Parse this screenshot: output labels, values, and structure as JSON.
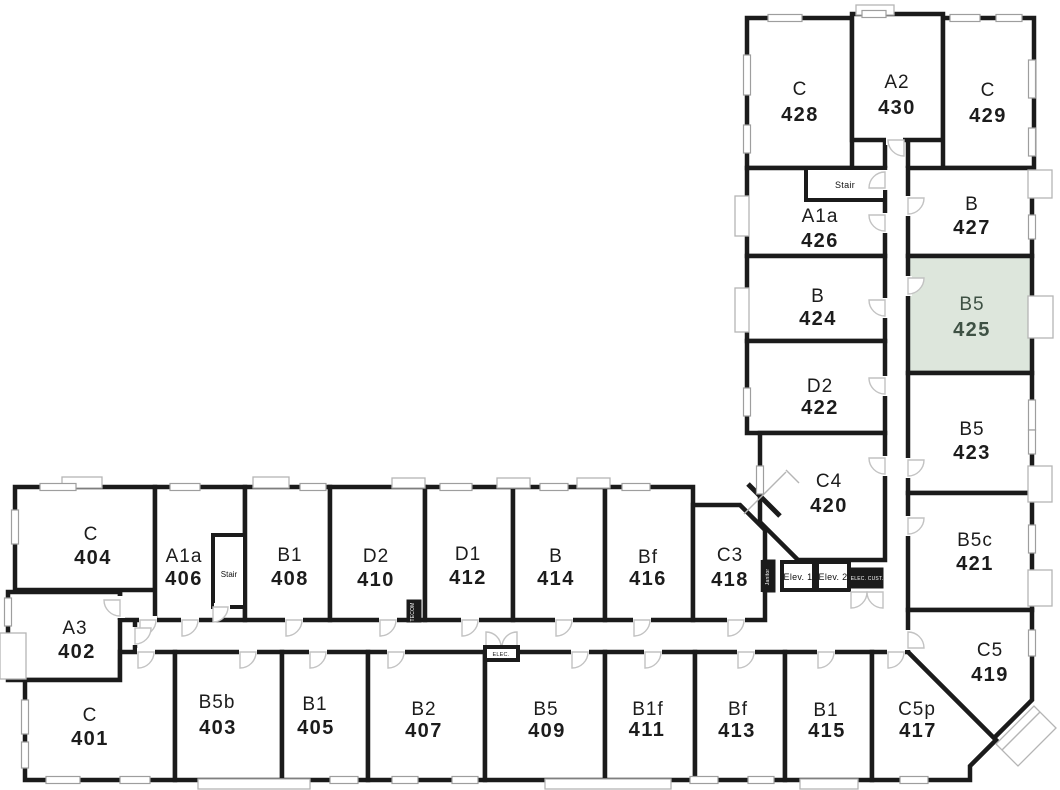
{
  "plan": {
    "description": "Residential building floor plan, fourth floor, L-shaped wing layout",
    "highlight": {
      "unit_type": "B5",
      "unit_number": "425",
      "fill": "#dde6dc",
      "text_color": "#3e5144"
    },
    "colors": {
      "wall": "#1b1b1b",
      "background": "#ffffff",
      "door_arc": "#c2c2c2",
      "window": "#9e9e9e",
      "label": "#1c1c1c"
    }
  },
  "units": [
    {
      "type": "C",
      "number": "428"
    },
    {
      "type": "A2",
      "number": "430"
    },
    {
      "type": "C",
      "number": "429"
    },
    {
      "type": "A1a",
      "number": "426"
    },
    {
      "type": "B",
      "number": "427"
    },
    {
      "type": "B",
      "number": "424"
    },
    {
      "type": "B5",
      "number": "425",
      "highlighted": true
    },
    {
      "type": "D2",
      "number": "422"
    },
    {
      "type": "B5",
      "number": "423"
    },
    {
      "type": "C4",
      "number": "420"
    },
    {
      "type": "B5c",
      "number": "421"
    },
    {
      "type": "C5",
      "number": "419"
    },
    {
      "type": "C",
      "number": "404"
    },
    {
      "type": "A1a",
      "number": "406"
    },
    {
      "type": "B1",
      "number": "408"
    },
    {
      "type": "D2",
      "number": "410"
    },
    {
      "type": "D1",
      "number": "412"
    },
    {
      "type": "B",
      "number": "414"
    },
    {
      "type": "Bf",
      "number": "416"
    },
    {
      "type": "C3",
      "number": "418"
    },
    {
      "type": "A3",
      "number": "402"
    },
    {
      "type": "C",
      "number": "401"
    },
    {
      "type": "B5b",
      "number": "403"
    },
    {
      "type": "B1",
      "number": "405"
    },
    {
      "type": "B2",
      "number": "407"
    },
    {
      "type": "B5",
      "number": "409"
    },
    {
      "type": "B1f",
      "number": "411"
    },
    {
      "type": "Bf",
      "number": "413"
    },
    {
      "type": "B1",
      "number": "415"
    },
    {
      "type": "C5p",
      "number": "417"
    }
  ],
  "services": {
    "stair_top": "Stair",
    "stair_bottom": "Stair",
    "elev1": "Elev. 1",
    "elev2": "Elev. 2",
    "elec_cust": "ELEC. CUST.",
    "elec": "ELEC.",
    "tecom": "TECOM",
    "janitor": "Janitor"
  }
}
